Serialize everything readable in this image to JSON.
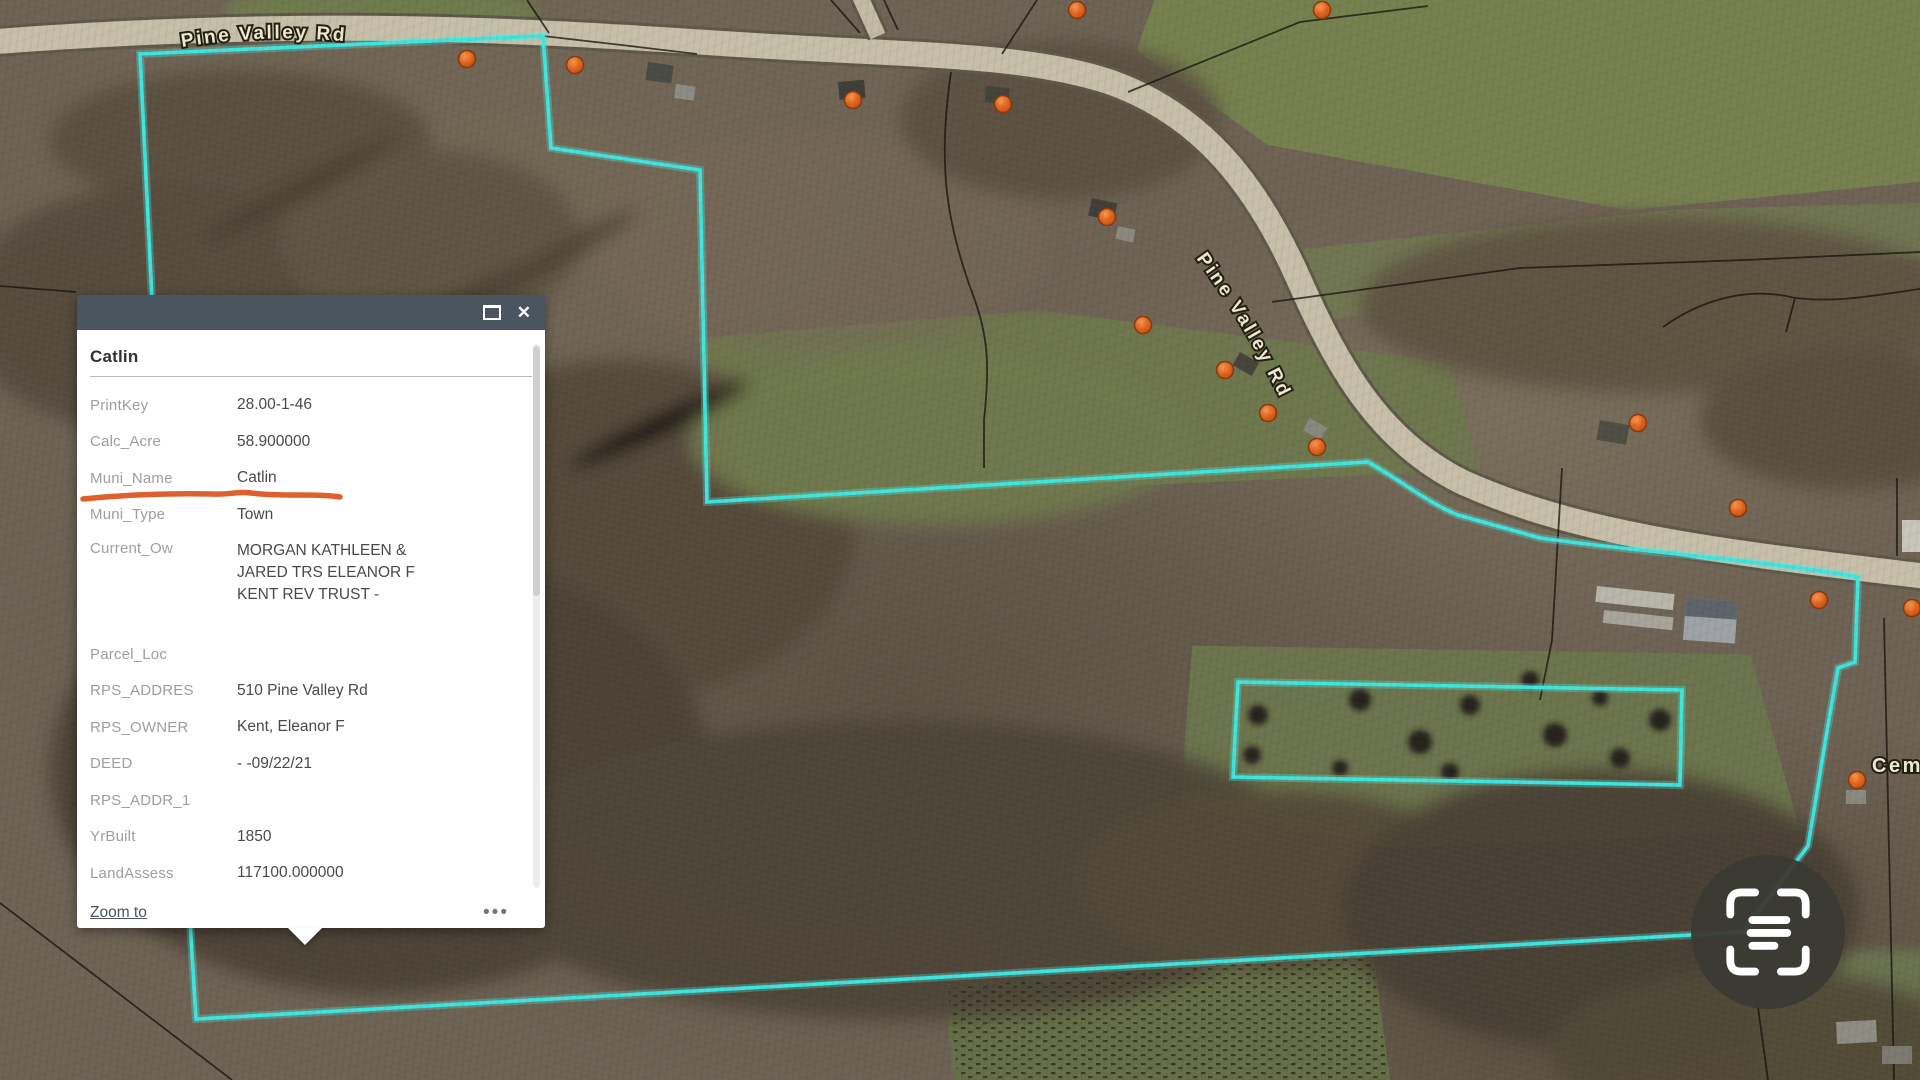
{
  "map": {
    "road_label_top": "Pine Valley Rd",
    "road_label_curve": "Pine Valley Rd",
    "cemetery_label": "Cem",
    "highlight_color": "#3FE6DF",
    "marker_color": "#E3641F"
  },
  "popup": {
    "title": "Catlin",
    "fields": [
      {
        "label": "PrintKey",
        "value": "28.00-1-46"
      },
      {
        "label": "Calc_Acre",
        "value": "58.900000"
      },
      {
        "label": "Muni_Name",
        "value": "Catlin"
      },
      {
        "label": "Muni_Type",
        "value": "Town"
      },
      {
        "label": "Current_Ow",
        "value": "MORGAN KATHLEEN & JARED TRS ELEANOR F KENT REV TRUST -"
      },
      {
        "label": "Parcel_Loc",
        "value": ""
      },
      {
        "label": "RPS_ADDRES",
        "value": "510 Pine Valley Rd"
      },
      {
        "label": "RPS_OWNER",
        "value": "Kent, Eleanor F"
      },
      {
        "label": "DEED",
        "value": "- -09/22/21"
      },
      {
        "label": "RPS_ADDR_1",
        "value": ""
      },
      {
        "label": "YrBuilt",
        "value": "1850"
      },
      {
        "label": "LandAssess",
        "value": "117100.000000"
      }
    ],
    "footer": {
      "zoom_to_label": "Zoom to",
      "more_options_glyph": "•••"
    },
    "window": {
      "close_glyph": "✕"
    },
    "annotation": {
      "target_field": "Calc_Acre",
      "color": "#DF5F2D",
      "type": "hand-drawn-underline"
    }
  }
}
